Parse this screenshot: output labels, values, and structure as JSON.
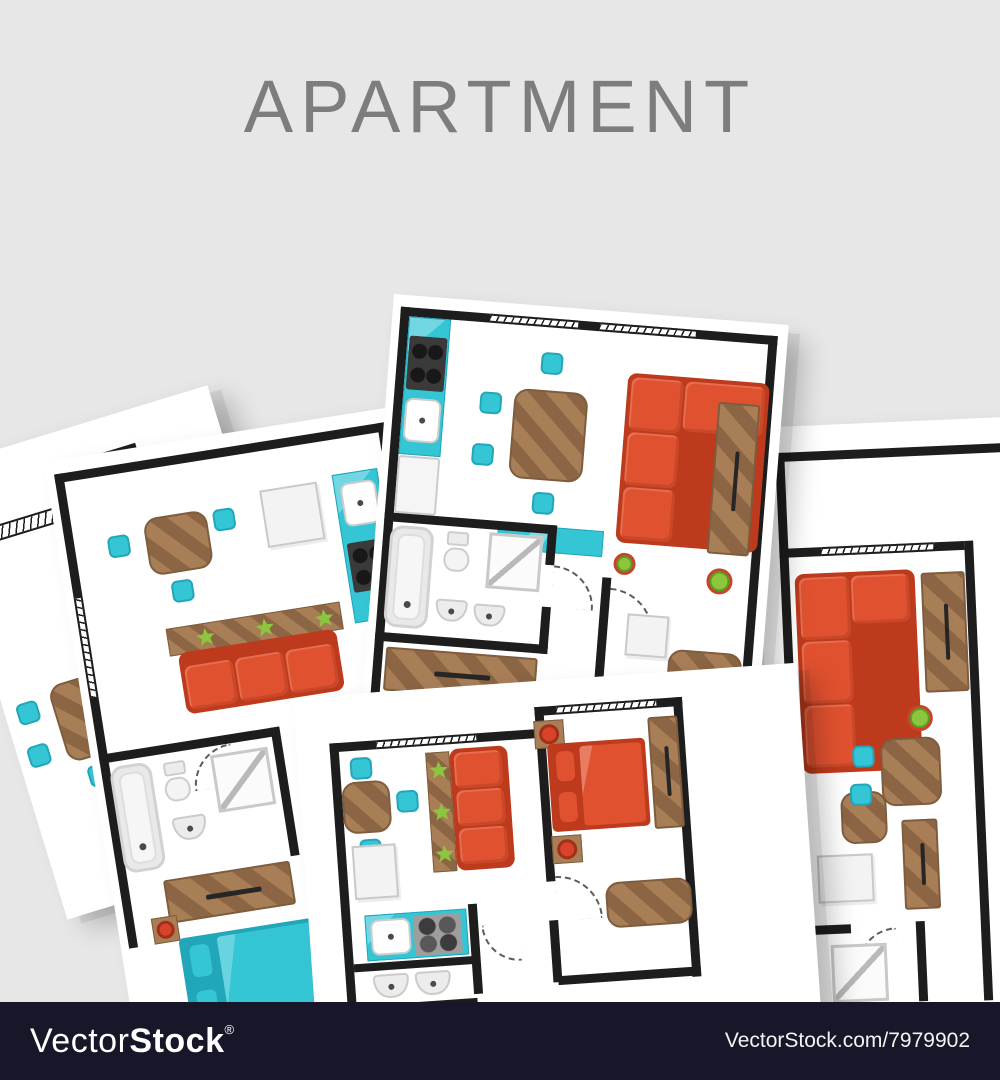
{
  "header": {
    "title": "APARTMENT"
  },
  "footer": {
    "logo": {
      "light": "Vector",
      "bold": "Stock",
      "registered": "®"
    },
    "credit": "VectorStock.com/7979902"
  },
  "palette": {
    "background": "#e7e7e7",
    "title_text": "#7d7d7d",
    "paper": "#ffffff",
    "wall": "#1d1d1d",
    "sofa_red": "#e0512f",
    "sofa_red_dark": "#bd3a1c",
    "accent_teal": "#35c6d6",
    "accent_teal_dark": "#22a6ba",
    "wood_brown": "#a87e57",
    "wood_brown_dark": "#8b6544",
    "wood_brown_edge": "#7e5c3e",
    "fixture_border": "#cccccc",
    "stove_black": "#3a3a3a",
    "stove_gray": "#9e9e9e",
    "plant_green": "#8cc63f",
    "plant_green_dark": "#5d9c1e",
    "pot_red": "#c5452c",
    "lamp_red": "#d8432b",
    "footer_background": "#171729",
    "footer_text": "#ffffff"
  }
}
